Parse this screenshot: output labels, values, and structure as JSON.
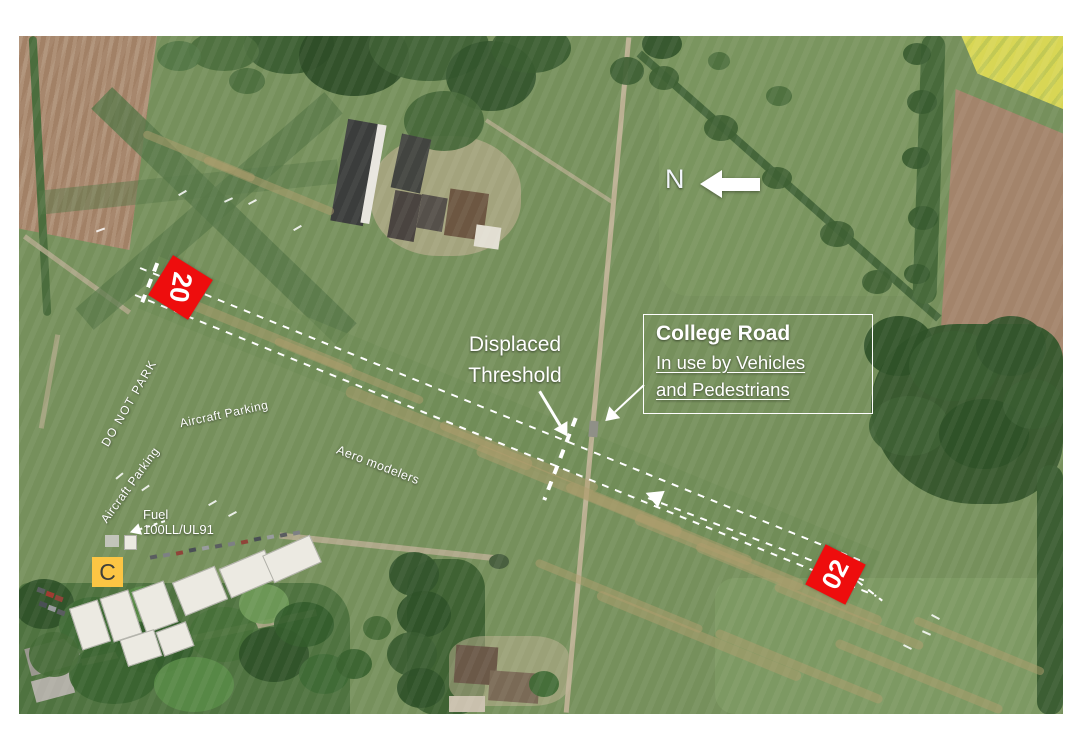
{
  "map": {
    "type": "aerial-photo",
    "subject": "grass airfield with annotated runway 02/20",
    "colors": {
      "marker_red": "#ee0d0d",
      "signal_square_yellow": "#fcc544",
      "annotation_white": "#ffffff"
    }
  },
  "annotations": {
    "north_label": "N",
    "runway_marker_20": "20",
    "runway_marker_02": "02",
    "displaced_threshold": {
      "line1": "Displaced",
      "line2": "Threshold"
    },
    "college_road": {
      "title": "College Road",
      "line1": "In use by Vehicles",
      "line2": "and Pedestrians"
    },
    "do_not_park": "DO NOT PARK",
    "aircraft_parking_upper": "Aircraft Parking",
    "aircraft_parking_lower": "Aircraft Parking",
    "aero_modelers": "Aero modelers",
    "fuel_label": "Fuel",
    "fuel_grade": "100LL/UL91",
    "signal_square": "C"
  }
}
